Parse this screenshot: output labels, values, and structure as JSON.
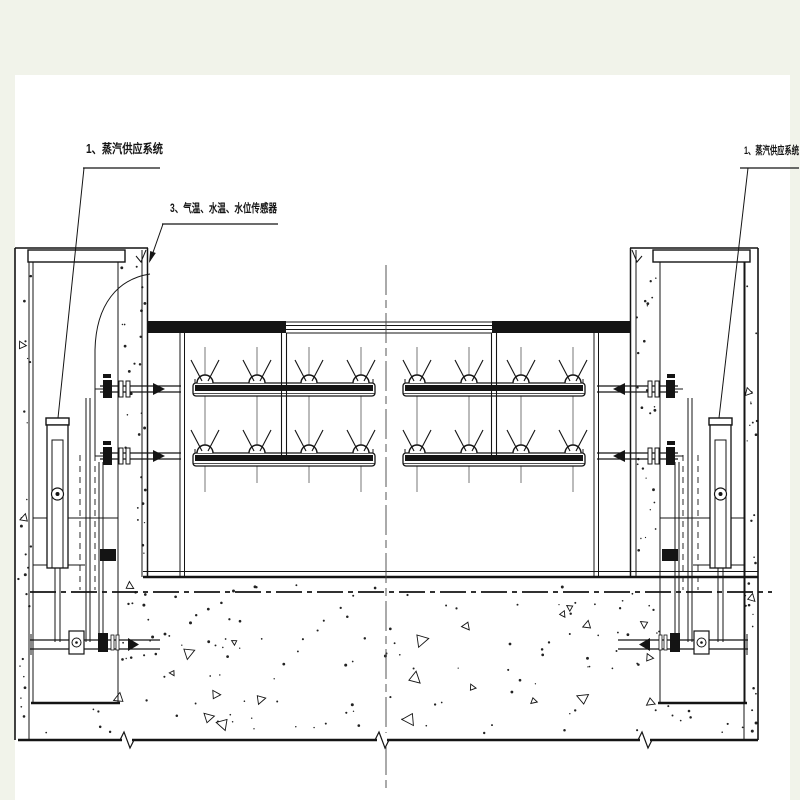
{
  "labels": {
    "steam_left": "1、蒸汽供应系统",
    "sensors": "3、气温、水温、水位传感器",
    "steam_right": "1、蒸汽供应系统"
  },
  "colors": {
    "line": "#141414",
    "thin_line": "#555555",
    "paper": "#ffffff",
    "margin": "#f1f3ea"
  }
}
